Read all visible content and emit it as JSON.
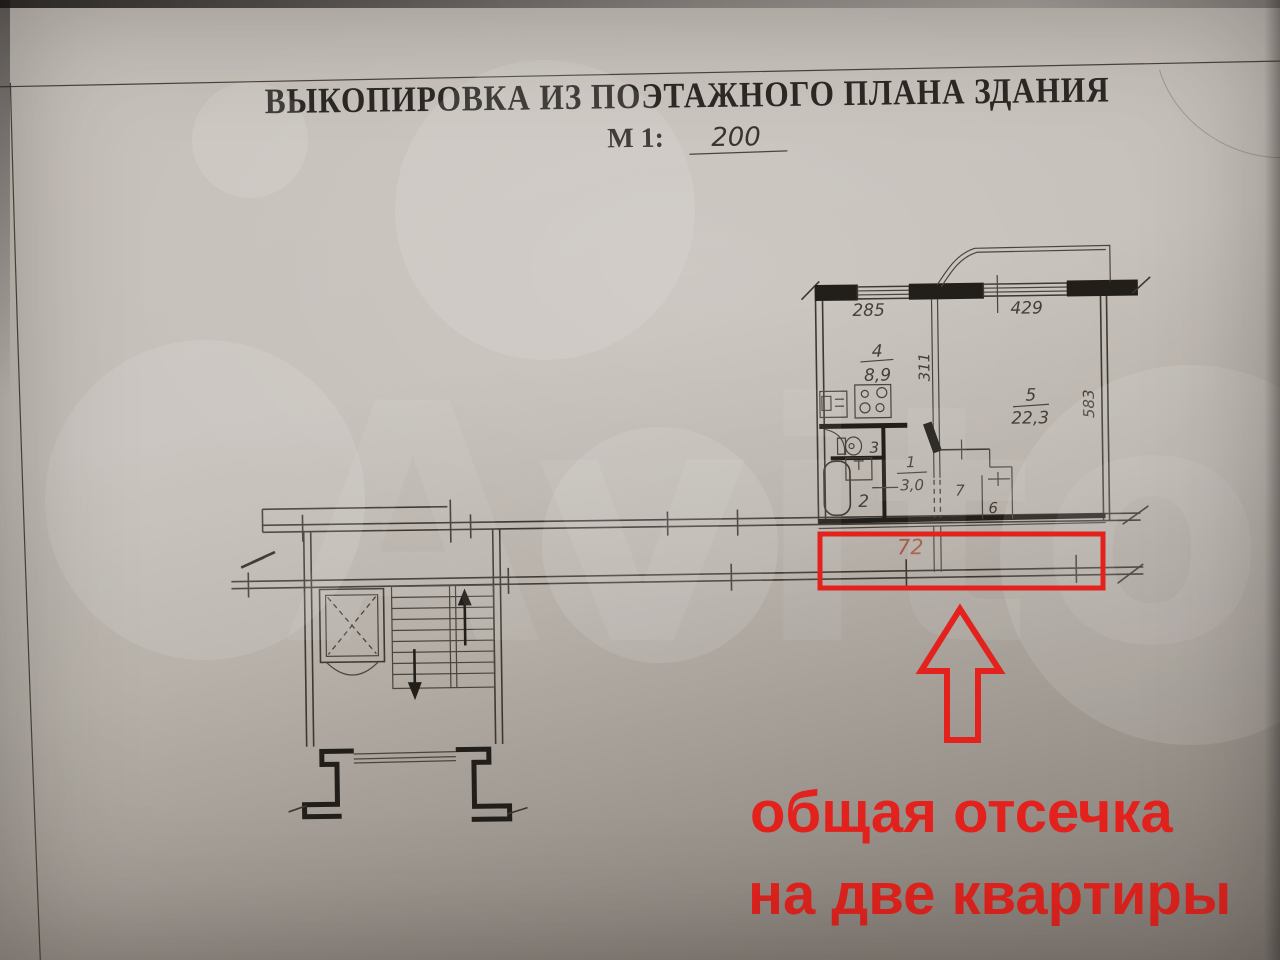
{
  "document": {
    "title": "ВЫКОПИРОВКА ИЗ ПОЭТАЖНОГО ПЛАНА ЗДАНИЯ",
    "scale_label": "М 1:",
    "scale_value": "200"
  },
  "plan": {
    "dim_window_left": "285",
    "dim_window_right": "429",
    "dim_kitchen_depth": "311",
    "dim_room_depth": "583",
    "kitchen": {
      "number": "4",
      "area": "8,9"
    },
    "living_room": {
      "number": "5",
      "area": "22,3"
    },
    "hall": {
      "number": "1",
      "area": "3,0"
    },
    "bathroom_number": "2",
    "wc_number": "3",
    "storage_right": "7",
    "storage_small": "6",
    "corridor_number": "72"
  },
  "annotation": {
    "line1": "общая отсечка",
    "line2": "на две квартиры"
  },
  "watermark_text": "Avito",
  "colors": {
    "annotation_red": "#e3221d",
    "corridor_number_color": "#a65a48",
    "ink": "#3e3831"
  }
}
